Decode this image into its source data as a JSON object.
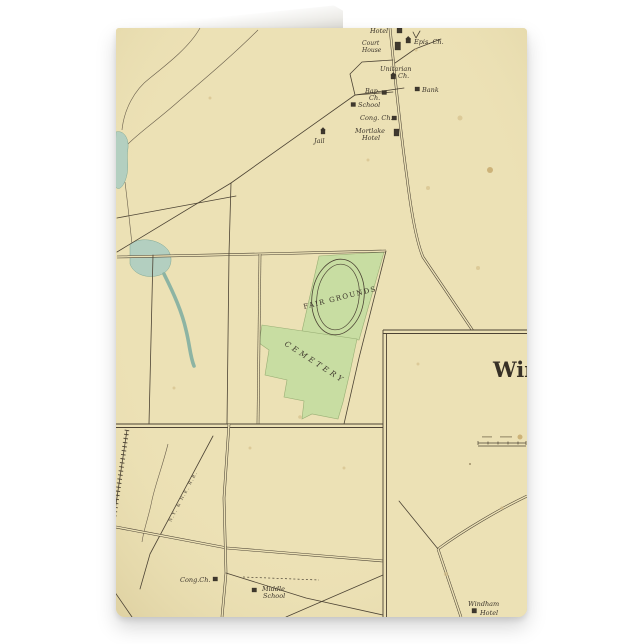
{
  "product": {
    "description": "Folded greeting card standing upright, printed with an antique town map"
  },
  "colors": {
    "page_bg": "#ffffff",
    "parchment": "#ece1b5",
    "map_line": "#4c4334",
    "label_ink": "#3c352b",
    "green_area": "#c8dda2",
    "green_edge": "#98ae74",
    "water": "#b3cfc0",
    "stain": "#d2ba85",
    "fold_white": "#ffffff"
  },
  "map": {
    "village_labels": {
      "hotel_top": "Hotel",
      "court_house_line1": "Court",
      "court_house_line2": "House",
      "epis_ch": "Epis. Ch.",
      "unitarian_line1": "Unitarian",
      "unitarian_line2": "Ch.",
      "bap_ch_line1": "Bap.",
      "bap_ch_line2": "Ch.",
      "bank": "Bank",
      "school": "School",
      "cong_ch": "Cong. Ch.",
      "mortlake_line1": "Mortlake",
      "mortlake_line2": "Hotel",
      "jail": "Jail"
    },
    "areas": {
      "fair_grounds": "FAIR GROUNDS",
      "cemetery": "CEMETERY"
    },
    "inset_left": {
      "cong_ch": "Cong.Ch.",
      "school_line1": "Middle",
      "school_line2": "School",
      "railroad": "N.Y. & N.E. R.R."
    },
    "inset_windham": {
      "title": "Win",
      "hotel_line1": "Windham",
      "hotel_line2": "Hotel"
    }
  }
}
